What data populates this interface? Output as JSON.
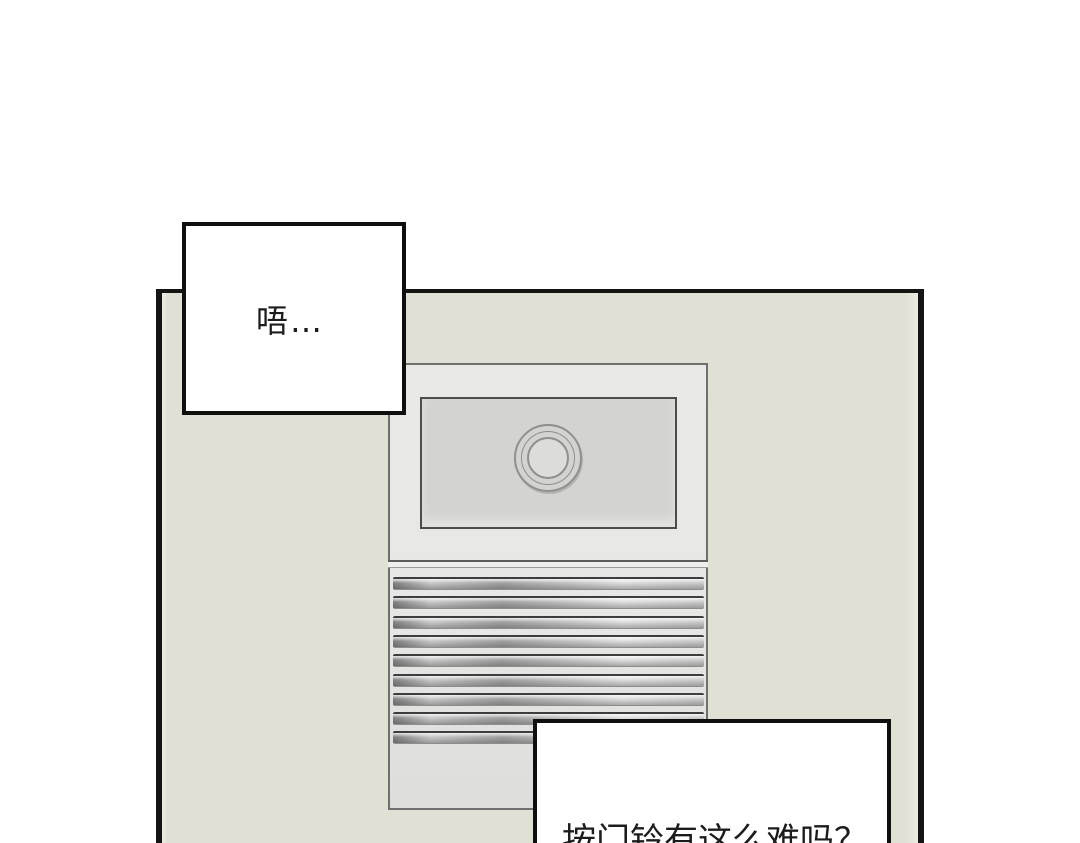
{
  "page": {
    "type": "comic-panel",
    "background_color": "#ffffff"
  },
  "colors": {
    "page-bg": "#ffffff",
    "panel-border": "#141414",
    "wall": "#e0e0d4",
    "wall-highlight": "#ebebe0",
    "unit-body": "#e7e7e5",
    "unit-outline": "#6f6f6d",
    "screen": "#d3d3d1",
    "screen-border": "#4c4c4c",
    "lens-ring": "#8f8f8f",
    "lens-fill": "#dcdcda",
    "bubble-bg": "#ffffff",
    "bubble-border": "#0f0f0f",
    "text": "#1c1c1c"
  },
  "doorbell": {
    "description": "wall-mounted intercom with camera screen, lens and speaker grille",
    "slat_count": 9
  },
  "speech_bubbles": [
    {
      "id": "bubble-top",
      "text": "唔…"
    },
    {
      "id": "bubble-bottom",
      "text": "按门铃有这么难吗？"
    }
  ]
}
